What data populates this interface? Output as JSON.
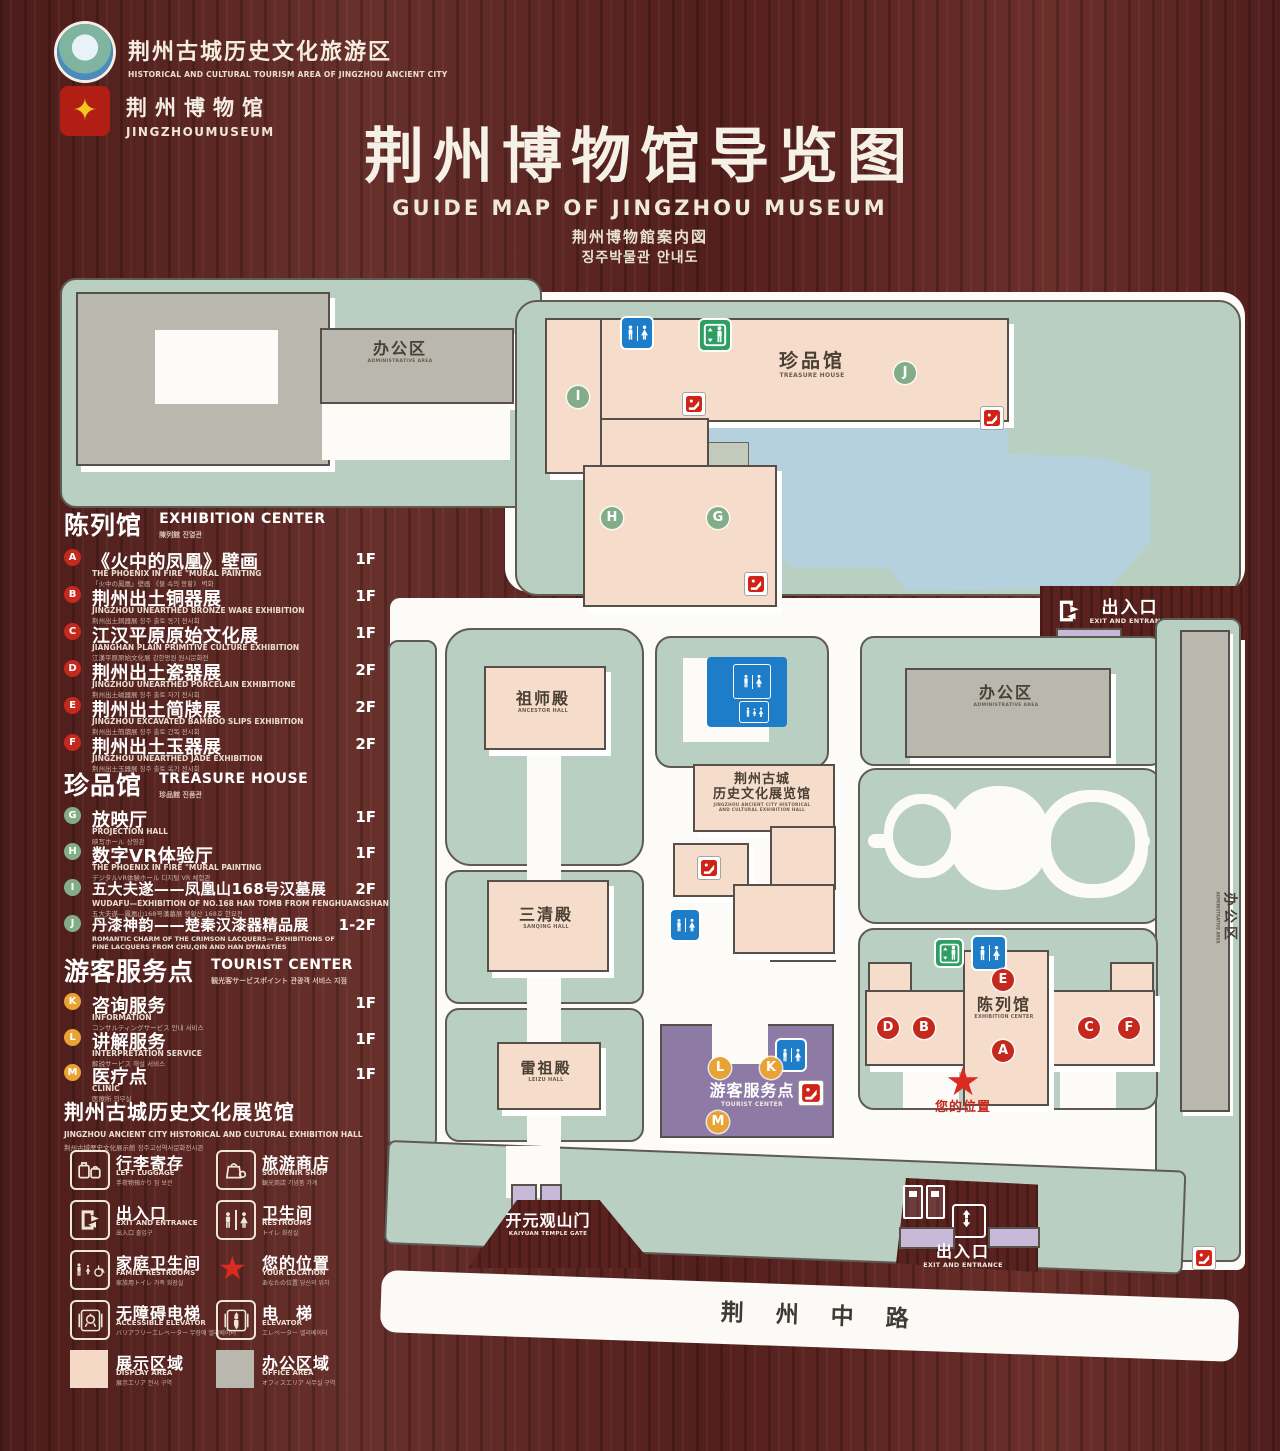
{
  "header": {
    "logo_area": {
      "cn": "荆州古城历史文化旅游区",
      "en": "HISTORICAL AND CULTURAL TOURISM AREA OF JINGZHOU ANCIENT CITY"
    },
    "logo_museum": {
      "cn": "荆州博物馆",
      "en": "JINGZHOUMUSEUM"
    },
    "title": "荆州博物馆导览图",
    "subtitle_en": "GUIDE MAP OF JINGZHOU MUSEUM",
    "subtitle_ja": "荆州博物館案内図",
    "subtitle_ko": "징주박물관 안내도"
  },
  "legend": {
    "exhibition": {
      "cn": "陈列馆",
      "en": "EXHIBITION CENTER",
      "sub": "陳列館  진열관",
      "items": [
        {
          "code": "A",
          "cn": "《火中的凤凰》壁画",
          "en": "THE PHOENIX IN FIRE \"MURAL PAINTING",
          "sub": "「火中の鳳凰」壁画  《불 속의 봉황》 벽화",
          "floor": "1F"
        },
        {
          "code": "B",
          "cn": "荆州出土铜器展",
          "en": "JINGZHOU UNEARTHED BRONZE WARE EXHIBITION",
          "sub": "荆州出土銅器展  징주 출토 동기 전시회",
          "floor": "1F"
        },
        {
          "code": "C",
          "cn": "江汉平原原始文化展",
          "en": "JIANGHAN PLAIN PRIMITIVE CULTURE EXHIBITION",
          "sub": "江漢平原原始文化展  강한평원 원시문화전",
          "floor": "1F"
        },
        {
          "code": "D",
          "cn": "荆州出土瓷器展",
          "en": "JINGZHOU UNEARTHED PORCELAIN EXHIBITIONE",
          "sub": "荆州出土磁器展  징주 출토 자기 전시회",
          "floor": "2F"
        },
        {
          "code": "E",
          "cn": "荆州出土简牍展",
          "en": "JINGZHOU EXCAVATED BAMBOO SLIPS EXHIBITION",
          "sub": "荆州出土簡牘展  징주 출토 간독 전시회",
          "floor": "2F"
        },
        {
          "code": "F",
          "cn": "荆州出土玉器展",
          "en": "JINGZHOU UNEARTHED JADE EXHIBITION",
          "sub": "荆州出土玉器展  징주 출토 옥기 전시회",
          "floor": "2F"
        }
      ]
    },
    "treasure": {
      "cn": "珍品馆",
      "en": "TREASURE HOUSE",
      "sub": "珍品館  진품관",
      "items": [
        {
          "code": "G",
          "cn": "放映厅",
          "en": "PROJECTION HALL",
          "sub": "映写ホール  상영관",
          "floor": "1F"
        },
        {
          "code": "H",
          "cn": "数字VR体验厅",
          "en": "THE PHOENIX IN FIRE \"MURAL PAINTING",
          "sub": "デジタルVR体験ホール  디지털 VR 체험관",
          "floor": "1F"
        },
        {
          "code": "I",
          "cn": "五大夫遂——凤凰山168号汉墓展",
          "en": "WUDAFU—EXHIBITION OF NO.168 HAN TOMB FROM FENGHUANGSHAN",
          "sub": "五大夫遂—鳳凰山168号漢墓展  봉황산 168호 한묘전",
          "floor": "2F"
        },
        {
          "code": "J",
          "cn": "丹漆神韵——楚秦汉漆器精品展",
          "en": "ROMANTIC CHARM OF THE CRIMSON LACQUERS— EXHIBITIONS OF FINE LACQUERS FROM CHU,QIN AND HAN DYNASTIES",
          "sub": "丹漆の神韻—楚秦漢漆器精品展  단칠신운 초·진·한 칠기 정품전",
          "floor": "1-2F"
        }
      ]
    },
    "tourist": {
      "cn": "游客服务点",
      "en": "TOURIST CENTER",
      "sub": "観光客サービスポイント  관광객 서비스 지점",
      "items": [
        {
          "code": "K",
          "cn": "咨询服务",
          "en": "INFORMATION",
          "sub": "コンサルティングサービス  안내 서비스",
          "floor": "1F"
        },
        {
          "code": "L",
          "cn": "讲解服务",
          "en": "INTERPRETATION SERVICE",
          "sub": "解説サービス  해설 서비스",
          "floor": "1F"
        },
        {
          "code": "M",
          "cn": "医疗点",
          "en": "CLINIC",
          "sub": "医療所  의무실",
          "floor": "1F"
        }
      ]
    },
    "hall_note": {
      "cn": "荆州古城历史文化展览馆",
      "en": "JINGZHOU ANCIENT CITY HISTORICAL AND CULTURAL EXHIBITION HALL",
      "sub": "荆州古城歴史文化展示館  징주고성역사문화전시관"
    },
    "facilities": [
      {
        "icon": "left-luggage",
        "cn": "行李寄存",
        "en": "LEFT LUGGAGE",
        "sub": "手荷物預かり  짐 보관"
      },
      {
        "icon": "souvenir-shop",
        "cn": "旅游商店",
        "en": "SOUVENIR SHOP",
        "sub": "観光商店  기념품 가게"
      },
      {
        "icon": "exit-entrance",
        "cn": "出入口",
        "en": "EXIT AND ENTRANCE",
        "sub": "出入口  출입구"
      },
      {
        "icon": "restrooms",
        "cn": "卫生间",
        "en": "RESTROOMS",
        "sub": "トイレ  화장실"
      },
      {
        "icon": "family-restrooms",
        "cn": "家庭卫生间",
        "en": "FAMILY RESTROOMS",
        "sub": "家族用トイレ  가족 화장실"
      },
      {
        "icon": "your-location",
        "cn": "您的位置",
        "en": "YOUR LOCATION",
        "sub": "あなたの位置  당신의 위치"
      },
      {
        "icon": "accessible-elevator",
        "cn": "无障碍电梯",
        "en": "ACCESSIBLE ELEVATOR",
        "sub": "バリアフリーエレベーター  무장애 엘리베이터"
      },
      {
        "icon": "elevator",
        "cn": "电　梯",
        "en": "ELEVATOR",
        "sub": "エレベーター  엘리베이터"
      }
    ],
    "areas": [
      {
        "cn": "展示区域",
        "en": "DISPLAY AREA",
        "sub": "展示エリア  전시 구역",
        "color": "#f3d9c6"
      },
      {
        "cn": "办公区域",
        "en": "OFFICE AREA",
        "sub": "オフィスエリア  사무실 구역",
        "color": "#b9b7ae"
      }
    ]
  },
  "map": {
    "labels": {
      "admin": {
        "cn": "办公区",
        "en": "ADMINISTRATIVE AREA"
      },
      "treasure": {
        "cn": "珍品馆",
        "en": "TREASURE HOUSE"
      },
      "ancestor": {
        "cn": "祖师殿",
        "en": "ANCESTOR HALL"
      },
      "sanqing": {
        "cn": "三清殿",
        "en": "SANQING HALL"
      },
      "leizu": {
        "cn": "雷祖殿",
        "en": "LEIZU HALL"
      },
      "hall": {
        "cn1": "荆州古城",
        "cn2": "历史文化展览馆",
        "en1": "JINGZHOU ANCIENT CITY HISTORICAL",
        "en2": "AND CULTURAL EXHIBITION HALL"
      },
      "exhibition": {
        "cn": "陈列馆",
        "en": "EXHIBITION CENTER"
      },
      "tourist": {
        "cn": "游客服务点",
        "en": "TOURIST CENTER"
      },
      "gate": {
        "cn": "开元观山门",
        "en": "KAIYUAN TEMPLE GATE"
      },
      "exit": {
        "cn": "出入口",
        "en": "EXIT AND ENTRANCE"
      },
      "road": "荆 州 中 路",
      "your_location": "您的位置"
    },
    "markers": {
      "I": "I",
      "J": "J",
      "H": "H",
      "G": "G",
      "E": "E",
      "D": "D",
      "B": "B",
      "A": "A",
      "C": "C",
      "F": "F",
      "L": "L",
      "K": "K",
      "M": "M"
    },
    "colors": {
      "display_area": "#f6dcca",
      "office_area": "#b9b7ae",
      "ground": "#b9cfc2",
      "water": "#b5d1dd",
      "tourist_center": "#8d7aa5",
      "marker_red": "#c5281c",
      "marker_green": "#83ad88",
      "marker_orange": "#e9a335",
      "restroom_blue": "#1e7dc8",
      "elevator_green": "#2f9e62",
      "location_red": "#d92b20"
    }
  }
}
